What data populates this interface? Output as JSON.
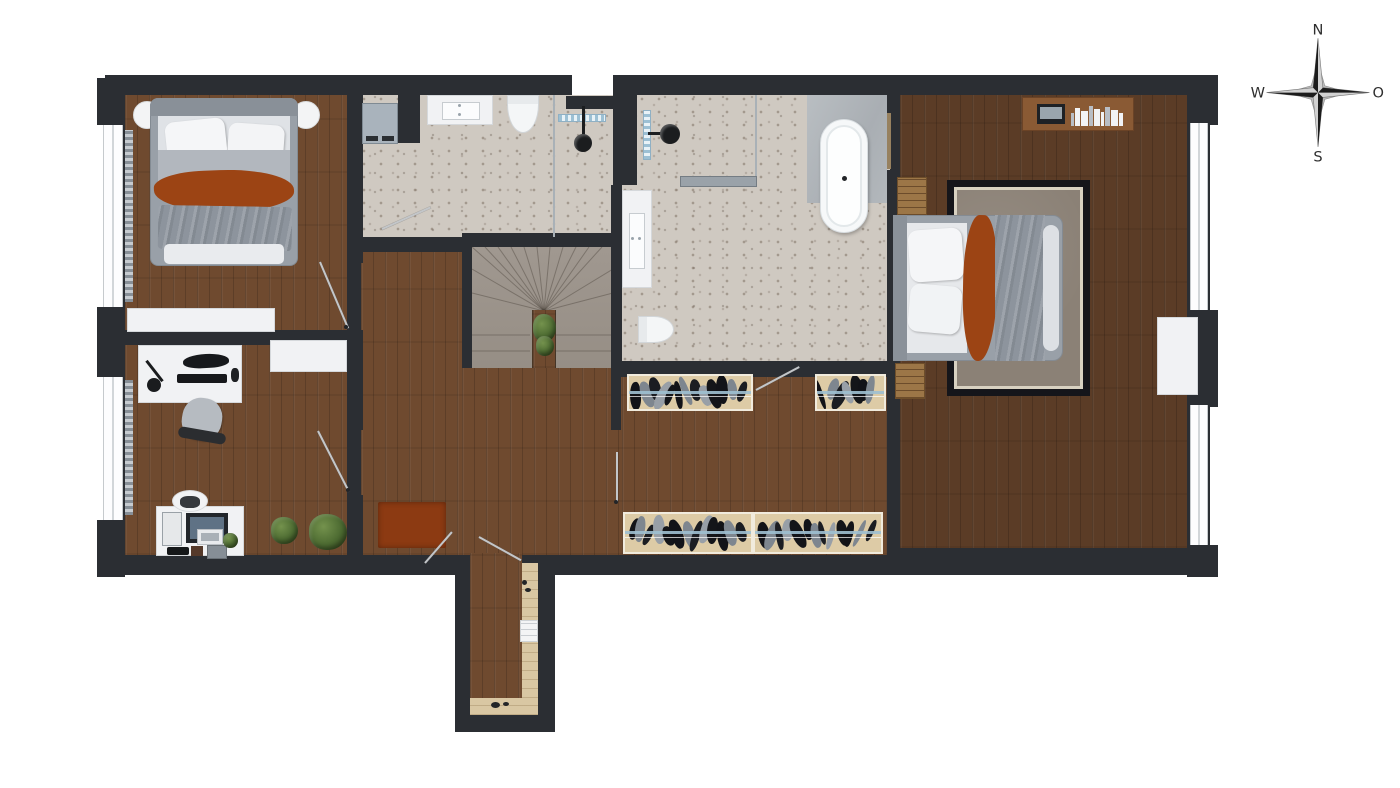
{
  "compass": {
    "north": "N",
    "east": "O",
    "south": "S",
    "west": "W"
  },
  "colors": {
    "wall": "#2b2e33",
    "wood": "#6f4a2f",
    "woodDark": "#5b3c26",
    "stairs": "#968e85",
    "tile": "#cfc9c1",
    "rust": "#9c4414",
    "bedGray": "#99a0a8",
    "blanket": "#8d949d",
    "rugCenter": "#8b8176",
    "rugTrim": "#d8d1c1",
    "rugBorder": "#15151a",
    "wardrobe": "#ddcba6",
    "rail": "#9fc0d2",
    "plant": "#4c6a31",
    "counter": "#d9c7a3",
    "radiator": "#97a0a8",
    "glass": "#a9b1b7",
    "redRug": "#8c3a12"
  }
}
